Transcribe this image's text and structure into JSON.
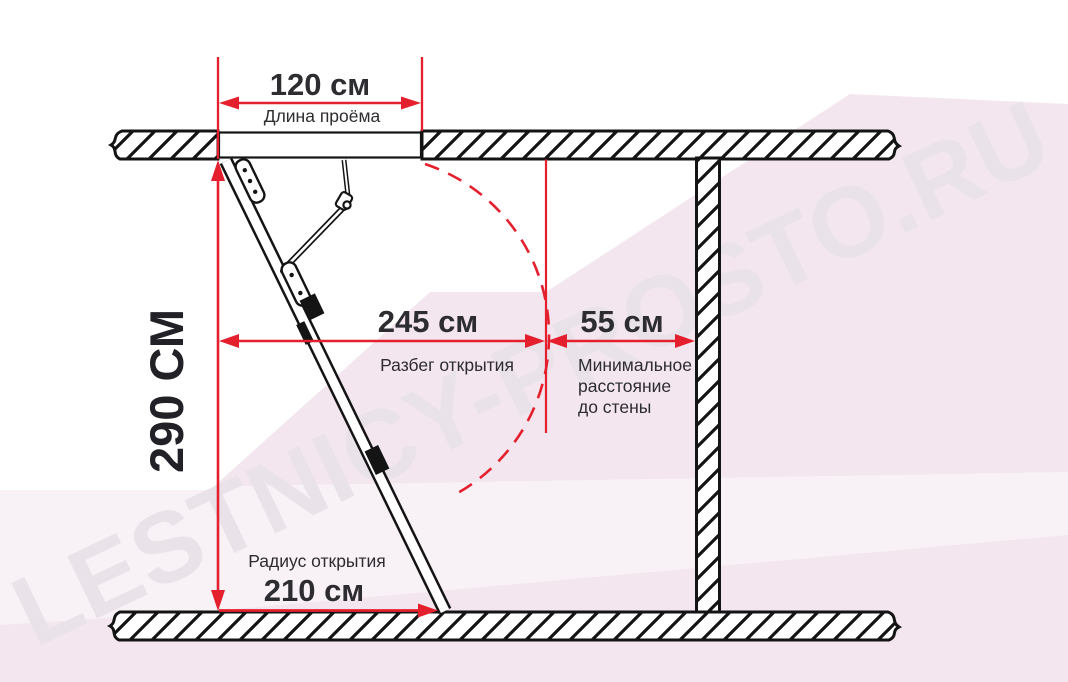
{
  "diagram": {
    "type": "attic-ladder-installation-dimensions",
    "dimensions": {
      "opening": {
        "value": "120 см",
        "caption": "Длина проёма"
      },
      "ceiling_height": {
        "value": "290 СМ"
      },
      "swing_span": {
        "value": "245 см",
        "caption": "Разбег открытия"
      },
      "wall_clearance": {
        "value": "55 см",
        "caption_line1": "Минимальное",
        "caption_line2": "расстояние",
        "caption_line3": "до стены"
      },
      "opening_radius": {
        "value": "210 см",
        "caption": "Радиус открытия"
      }
    }
  },
  "watermark": {
    "text": "LESTNICY-PROSTO.RU"
  },
  "colors": {
    "dimension_red": "#e4202e",
    "label_text": "#2d2c30",
    "structure_black": "#141414",
    "background_pink": "#f3e6ee",
    "watermark_gray": "#e9e3e9"
  }
}
